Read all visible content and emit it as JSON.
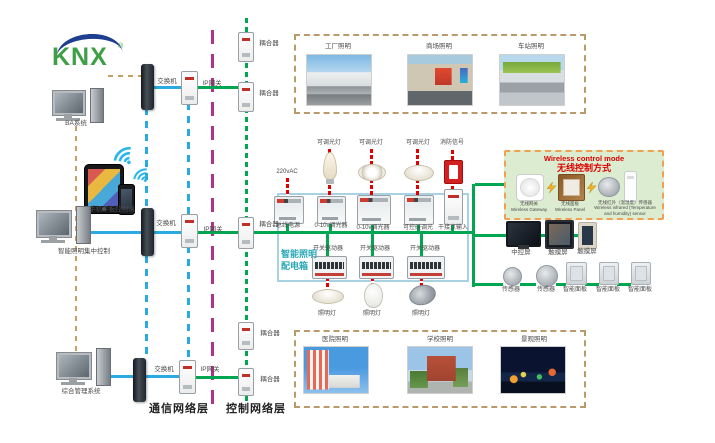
{
  "logo": {
    "text": "KNX",
    "reg": "®"
  },
  "left_column": {
    "ba_system_label": "BA系统",
    "mobile_label": "手机平板控制端",
    "central_control_label": "智能照明集中控制",
    "management_label": "综合管理系统"
  },
  "layers": {
    "communication": "通信网络层",
    "control": "控制网络层"
  },
  "network": {
    "switches": [
      "交换机",
      "交换机",
      "交换机"
    ],
    "gateways": [
      "IP网关",
      "IP网关",
      "IP网关"
    ],
    "couplers": [
      "耦合器",
      "耦合器",
      "耦合器",
      "耦合器",
      "耦合器"
    ]
  },
  "scenes_top": [
    "工厂照明",
    "商场照明",
    "车站照明"
  ],
  "scenes_bottom": [
    "医院照明",
    "学校照明",
    "景观照明"
  ],
  "cabinet": {
    "name_line1": "智能照明",
    "name_line2": "配电箱",
    "power": "220vAC",
    "modules": [
      "总线电源",
      "0-10v调光器",
      "0-10v调光器",
      "可控硅调光",
      "干接点输入"
    ],
    "top_loads": [
      "可调光灯",
      "可调光灯",
      "可调光灯",
      "消防信号"
    ],
    "drivers": [
      "开关驱动器",
      "开关驱动器",
      "开关驱动器"
    ],
    "bottom_loads": [
      "照明灯",
      "照明灯",
      "照明灯"
    ]
  },
  "wireless": {
    "title_en": "Wireless control mode",
    "title_zh": "无线控制方式",
    "devices": [
      {
        "zh": "无线网关",
        "en": "Wireless Gateway"
      },
      {
        "zh": "无线面板",
        "en": "Wireless Panel"
      },
      {
        "zh": "无线红外（温湿度）传感器",
        "en": "Wireless infrared (Temperature and humidity) sensor"
      }
    ]
  },
  "right_devices": {
    "screens": [
      "中控屏",
      "触摸屏",
      "触摸屏"
    ],
    "sensors": [
      "传感器",
      "传感器"
    ],
    "panels": [
      "智能面板",
      "智能面板",
      "智能面板"
    ]
  },
  "colors": {
    "bus_green": "#00a650",
    "lan_blue": "#29aae1",
    "layer_magenta": "#b03388",
    "link_tan": "#c9a063",
    "power_red": "#e00000",
    "cabinet_border": "#a8d2e2",
    "cabinet_text": "#2aa8b8",
    "wireless_bg": "#dcecd0",
    "wireless_border": "#f0a050",
    "wireless_title": "#dd0000"
  }
}
